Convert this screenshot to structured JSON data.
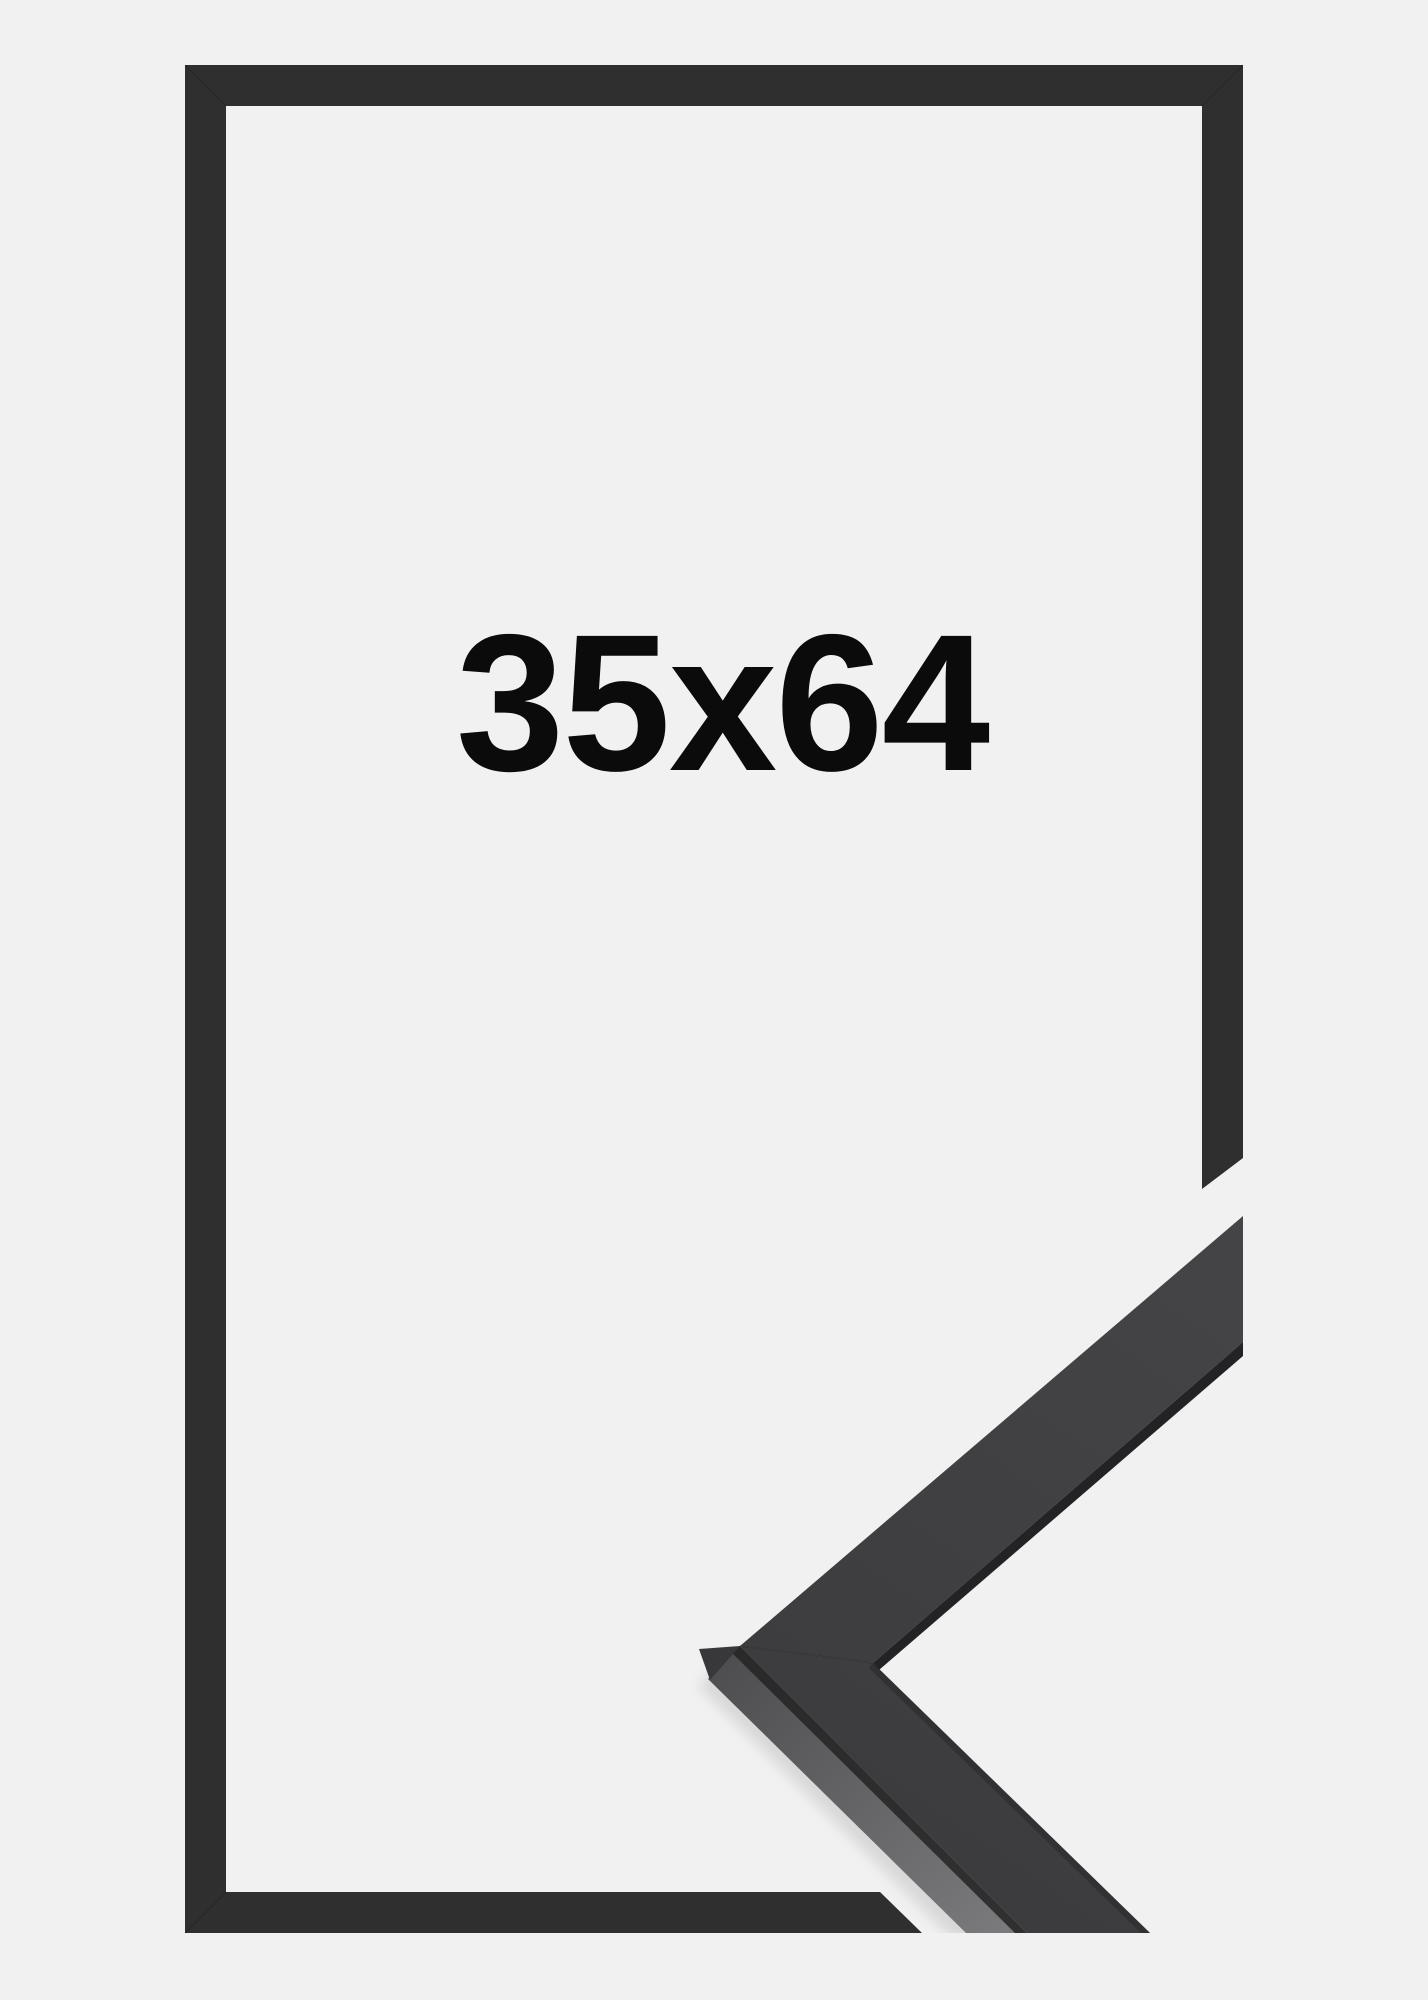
{
  "product_image": {
    "description_label": "frame-size-product-image",
    "size_label": "35x64"
  },
  "colors": {
    "background": "#f1f1f2",
    "frame_outline": "#2f2f30",
    "corner_face_light": "#454547",
    "corner_face_dark": "#3a3a3c",
    "corner_side_light": "#7a7a7c",
    "corner_side_dark": "#4e4e50",
    "corner_edge_strip": "#232326",
    "text": "#0b0b0b"
  }
}
